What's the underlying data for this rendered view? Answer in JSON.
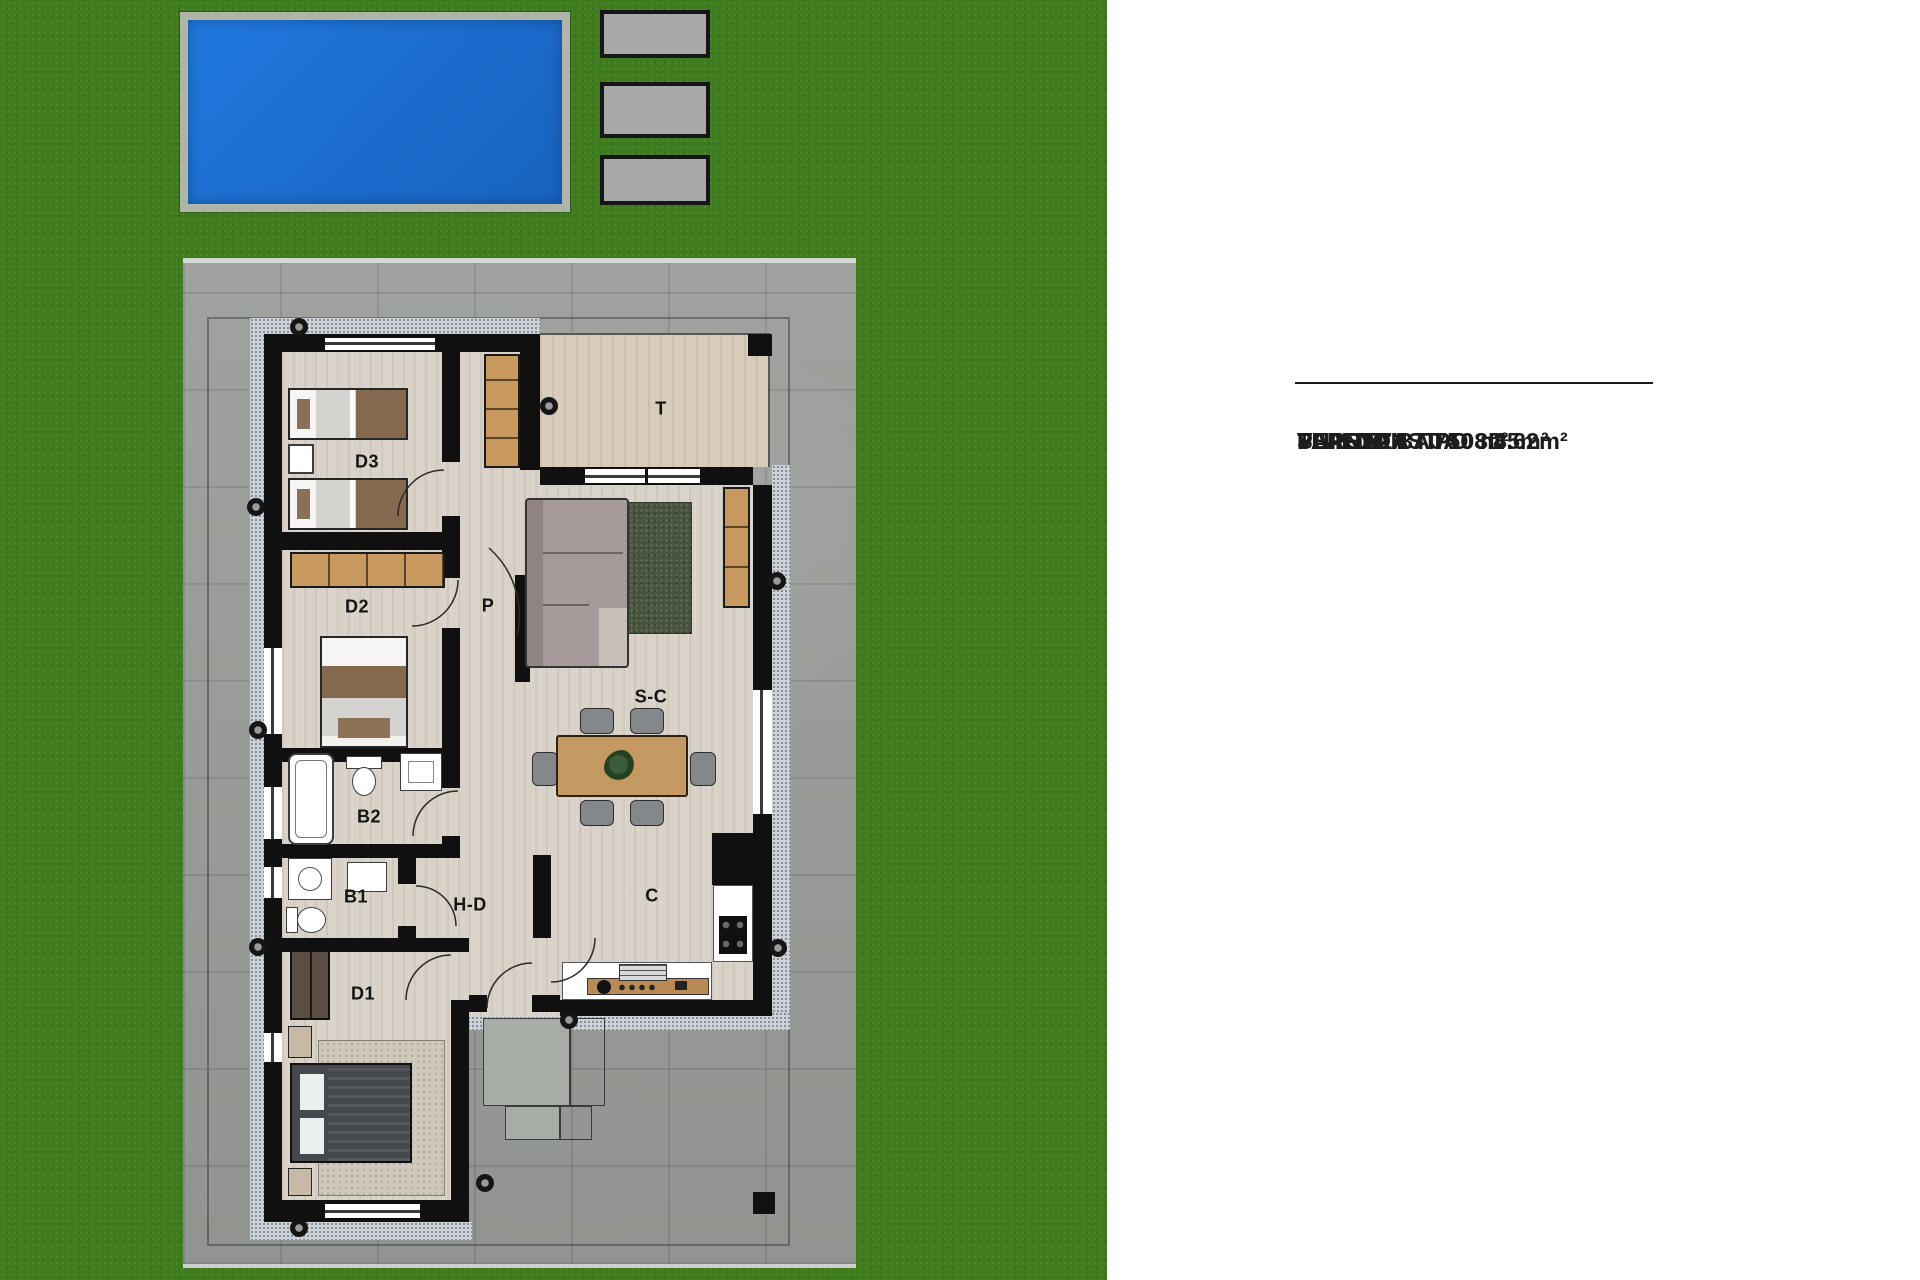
{
  "colors": {
    "grass": "#3E7C1E",
    "pool_water": "#1B6CCF",
    "pool_deck": "#AFB5A8",
    "paved_slab": "#A8A8A6",
    "driveway_concrete": "#9A9D99",
    "walkway": "#CCD2D8",
    "wall": "#101010",
    "interior_floor": "#D9D2C8",
    "terrace_floor": "#D8CCBA",
    "wood_furniture": "#C8995F",
    "label_text": "#141414"
  },
  "site": {
    "pool": "swimming-pool",
    "slab_count": 3
  },
  "floor_plan": {
    "room_labels": [
      {
        "id": "d3",
        "label": "D3"
      },
      {
        "id": "d2",
        "label": "D2"
      },
      {
        "id": "b2",
        "label": "B2"
      },
      {
        "id": "b1",
        "label": "B1"
      },
      {
        "id": "d1",
        "label": "D1"
      },
      {
        "id": "p",
        "label": "P"
      },
      {
        "id": "t",
        "label": "T"
      },
      {
        "id": "sc",
        "label": "S-C"
      },
      {
        "id": "hd",
        "label": "H-D"
      },
      {
        "id": "c",
        "label": "C"
      }
    ]
  },
  "info_panel": {
    "lines": [
      "VIVIENDA TIPO 3D",
      "PLANTA BAJA",
      "SUP. CONST. 108.85m²",
      "TERRAZA             4.62m²",
      "PARCELA    750 m²"
    ]
  }
}
